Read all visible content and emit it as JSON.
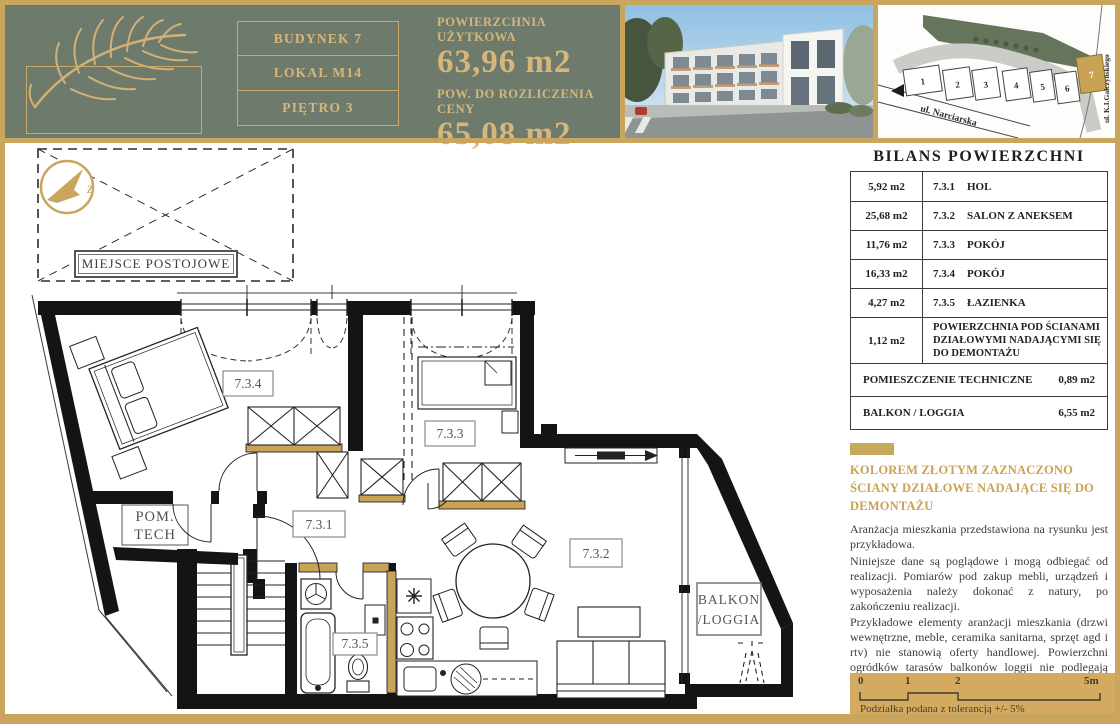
{
  "colors": {
    "gold": "#c9a254",
    "green": "#6e7b6c",
    "gold_panel": "#d3aa5f"
  },
  "header": {
    "building_label": "BUDYNEK 7",
    "unit_label": "LOKAL M14",
    "floor_label": "PIĘTRO 3",
    "usable_area_label": "POWIERZCHNIA UŻYTKOWA",
    "usable_area_value": "63,96 m2",
    "price_area_label": "POW. DO ROZLICZENIA CENY",
    "price_area_value": "65,08 m2"
  },
  "site_map": {
    "street_main": "ul. Narciarska",
    "street_side": "ul. K.I.Gałczyńskiego",
    "buildings": [
      "1",
      "2",
      "3",
      "4",
      "5",
      "6",
      "7"
    ],
    "highlighted_building": "7"
  },
  "plan": {
    "parking_label": "MIEJSCE POSTOJOWE",
    "compass_letter": "z",
    "tech_room_line1": "POM.",
    "tech_room_line2": "TECH",
    "balcony_line1": "BALKON",
    "balcony_line2": "/LOGGIA",
    "rooms": {
      "hall": "7.3.1",
      "living": "7.3.2",
      "room3": "7.3.3",
      "room4": "7.3.4",
      "bath": "7.3.5"
    }
  },
  "balance_table": {
    "title": "BILANS POWIERZCHNI",
    "rows": [
      {
        "area": "5,92 m2",
        "code": "7.3.1",
        "name": "HOL"
      },
      {
        "area": "25,68 m2",
        "code": "7.3.2",
        "name": "SALON Z ANEKSEM"
      },
      {
        "area": "11,76 m2",
        "code": "7.3.3",
        "name": "POKÓJ"
      },
      {
        "area": "16,33 m2",
        "code": "7.3.4",
        "name": "POKÓJ"
      },
      {
        "area": "4,27 m2",
        "code": "7.3.5",
        "name": "ŁAZIENKA"
      }
    ],
    "wall_row": {
      "area": "1,12 m2",
      "name": "POWIERZCHNIA POD ŚCIANAMI DZIAŁOWYMI NADAJĄCYMI SIĘ DO DEMONTAŻU"
    },
    "footer_rows": [
      {
        "name": "POMIESZCZENIE TECHNICZNE",
        "area": "0,89 m2"
      },
      {
        "name": "BALKON / LOGGIA",
        "area": "6,55 m2"
      }
    ]
  },
  "legend": {
    "heading": "KOLOREM ZŁOTYM ZAZNACZONO ŚCIANY DZIAŁOWE NADAJĄCE SIĘ DO DEMONTAŻU",
    "paragraphs": [
      "Aranżacja mieszkania przedstawiona na rysunku jest przykładowa.",
      "Niniejsze dane są poglądowe i mogą odbiegać od realizacji. Pomiarów pod zakup mebli, urządzeń i wyposażenia należy dokonać z natury, po zakończeniu realizacji.",
      "Przykładowe elementy aranżacji mieszkania (drzwi wewnętrzne, meble, ceramika sanitarna, sprzęt agd i rtv) nie stanowią oferty handlowej. Powierzchni ogródków tarasów balkonów loggii nie podlegają obmiarowi."
    ]
  },
  "scale_bar": {
    "ticks": [
      "0",
      "1",
      "2",
      "5m"
    ],
    "note": "Podziałka podana z tolerancją +/- 5%"
  }
}
